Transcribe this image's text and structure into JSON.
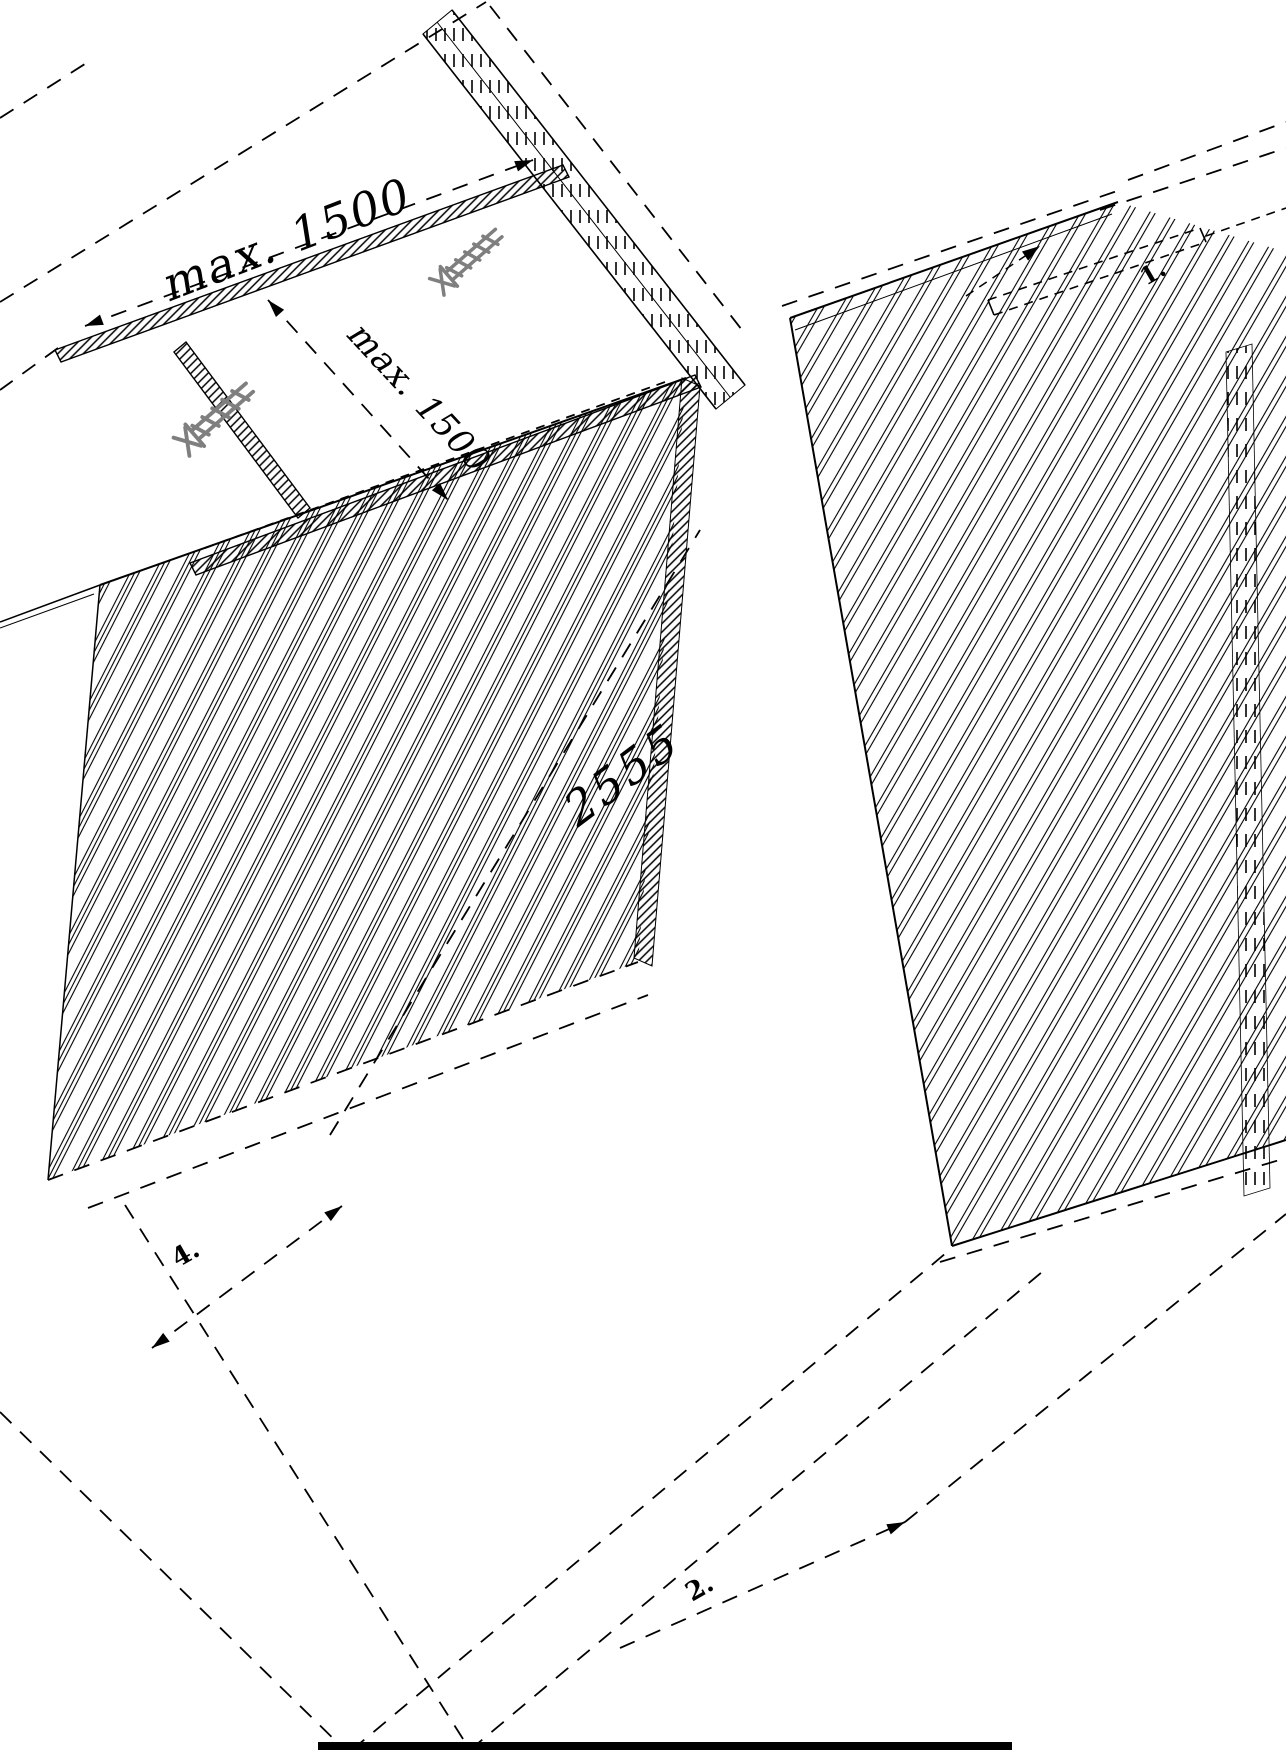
{
  "diagram": {
    "type": "isometric-assembly-instruction",
    "description": "black and white CAD line drawing of wall panelling / batten assembly",
    "labels": {
      "dim_top": "max. 1500",
      "dim_mid": "max. 1500",
      "dim_height": "2555",
      "step_1": "1.",
      "step_2": "2.",
      "step_4": "4."
    },
    "icons": [
      {
        "name": "screw-icon",
        "count": 2,
        "color": "#7f7f7f"
      }
    ],
    "colors": {
      "line": "#000000",
      "screw": "#7f7f7f",
      "background": "#ffffff"
    }
  }
}
